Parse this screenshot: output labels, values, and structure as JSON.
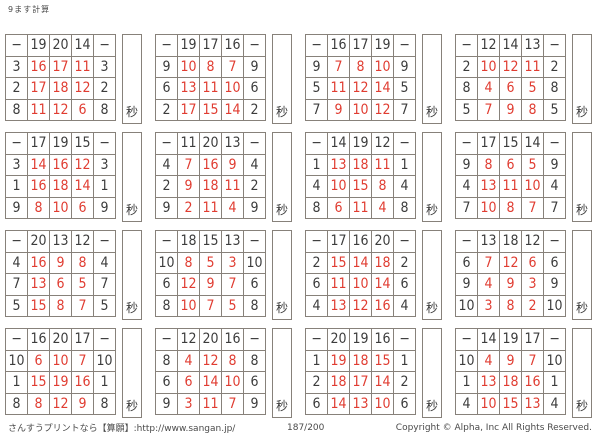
{
  "page": {
    "title": "9ます計算",
    "minus_sign": "−",
    "seconds_label": "秒",
    "footer": {
      "left": "さんすうプリントなら【算願】:http://www.sangan.jp/",
      "page_number": "187/200",
      "copyright": "Copyright © Alpha, Inc All Rights Reserved."
    }
  },
  "grids": [
    {
      "top": [
        "19",
        "20",
        "14"
      ],
      "rows": [
        {
          "left": "3",
          "answers": [
            "16",
            "17",
            "11"
          ]
        },
        {
          "left": "2",
          "answers": [
            "17",
            "18",
            "12"
          ]
        },
        {
          "left": "8",
          "answers": [
            "11",
            "12",
            "6"
          ]
        }
      ]
    },
    {
      "top": [
        "19",
        "17",
        "16"
      ],
      "rows": [
        {
          "left": "9",
          "answers": [
            "10",
            "8",
            "7"
          ]
        },
        {
          "left": "6",
          "answers": [
            "13",
            "11",
            "10"
          ]
        },
        {
          "left": "2",
          "answers": [
            "17",
            "15",
            "14"
          ]
        }
      ]
    },
    {
      "top": [
        "16",
        "17",
        "19"
      ],
      "rows": [
        {
          "left": "9",
          "answers": [
            "7",
            "8",
            "10"
          ]
        },
        {
          "left": "5",
          "answers": [
            "11",
            "12",
            "14"
          ]
        },
        {
          "left": "7",
          "answers": [
            "9",
            "10",
            "12"
          ]
        }
      ]
    },
    {
      "top": [
        "12",
        "14",
        "13"
      ],
      "rows": [
        {
          "left": "2",
          "answers": [
            "10",
            "12",
            "11"
          ]
        },
        {
          "left": "8",
          "answers": [
            "4",
            "6",
            "5"
          ]
        },
        {
          "left": "5",
          "answers": [
            "7",
            "9",
            "8"
          ]
        }
      ]
    },
    {
      "top": [
        "17",
        "19",
        "15"
      ],
      "rows": [
        {
          "left": "3",
          "answers": [
            "14",
            "16",
            "12"
          ]
        },
        {
          "left": "1",
          "answers": [
            "16",
            "18",
            "14"
          ]
        },
        {
          "left": "9",
          "answers": [
            "8",
            "10",
            "6"
          ]
        }
      ]
    },
    {
      "top": [
        "11",
        "20",
        "13"
      ],
      "rows": [
        {
          "left": "4",
          "answers": [
            "7",
            "16",
            "9"
          ]
        },
        {
          "left": "2",
          "answers": [
            "9",
            "18",
            "11"
          ]
        },
        {
          "left": "9",
          "answers": [
            "2",
            "11",
            "4"
          ]
        }
      ]
    },
    {
      "top": [
        "14",
        "19",
        "12"
      ],
      "rows": [
        {
          "left": "1",
          "answers": [
            "13",
            "18",
            "11"
          ]
        },
        {
          "left": "4",
          "answers": [
            "10",
            "15",
            "8"
          ]
        },
        {
          "left": "8",
          "answers": [
            "6",
            "11",
            "4"
          ]
        }
      ]
    },
    {
      "top": [
        "17",
        "15",
        "14"
      ],
      "rows": [
        {
          "left": "9",
          "answers": [
            "8",
            "6",
            "5"
          ]
        },
        {
          "left": "4",
          "answers": [
            "13",
            "11",
            "10"
          ]
        },
        {
          "left": "7",
          "answers": [
            "10",
            "8",
            "7"
          ]
        }
      ]
    },
    {
      "top": [
        "20",
        "13",
        "12"
      ],
      "rows": [
        {
          "left": "4",
          "answers": [
            "16",
            "9",
            "8"
          ]
        },
        {
          "left": "7",
          "answers": [
            "13",
            "6",
            "5"
          ]
        },
        {
          "left": "5",
          "answers": [
            "15",
            "8",
            "7"
          ]
        }
      ]
    },
    {
      "top": [
        "18",
        "15",
        "13"
      ],
      "rows": [
        {
          "left": "10",
          "answers": [
            "8",
            "5",
            "3"
          ]
        },
        {
          "left": "6",
          "answers": [
            "12",
            "9",
            "7"
          ]
        },
        {
          "left": "8",
          "answers": [
            "10",
            "7",
            "5"
          ]
        }
      ]
    },
    {
      "top": [
        "17",
        "16",
        "20"
      ],
      "rows": [
        {
          "left": "2",
          "answers": [
            "15",
            "14",
            "18"
          ]
        },
        {
          "left": "6",
          "answers": [
            "11",
            "10",
            "14"
          ]
        },
        {
          "left": "4",
          "answers": [
            "13",
            "12",
            "16"
          ]
        }
      ]
    },
    {
      "top": [
        "13",
        "18",
        "12"
      ],
      "rows": [
        {
          "left": "6",
          "answers": [
            "7",
            "12",
            "6"
          ]
        },
        {
          "left": "9",
          "answers": [
            "4",
            "9",
            "3"
          ]
        },
        {
          "left": "10",
          "answers": [
            "3",
            "8",
            "2"
          ]
        }
      ]
    },
    {
      "top": [
        "16",
        "20",
        "17"
      ],
      "rows": [
        {
          "left": "10",
          "answers": [
            "6",
            "10",
            "7"
          ]
        },
        {
          "left": "1",
          "answers": [
            "15",
            "19",
            "16"
          ]
        },
        {
          "left": "8",
          "answers": [
            "8",
            "12",
            "9"
          ]
        }
      ]
    },
    {
      "top": [
        "12",
        "20",
        "16"
      ],
      "rows": [
        {
          "left": "8",
          "answers": [
            "4",
            "12",
            "8"
          ]
        },
        {
          "left": "6",
          "answers": [
            "6",
            "14",
            "10"
          ]
        },
        {
          "left": "9",
          "answers": [
            "3",
            "11",
            "7"
          ]
        }
      ]
    },
    {
      "top": [
        "20",
        "19",
        "16"
      ],
      "rows": [
        {
          "left": "1",
          "answers": [
            "19",
            "18",
            "15"
          ]
        },
        {
          "left": "2",
          "answers": [
            "18",
            "17",
            "14"
          ]
        },
        {
          "left": "6",
          "answers": [
            "14",
            "13",
            "10"
          ]
        }
      ]
    },
    {
      "top": [
        "14",
        "19",
        "17"
      ],
      "rows": [
        {
          "left": "10",
          "answers": [
            "4",
            "9",
            "7"
          ]
        },
        {
          "left": "1",
          "answers": [
            "13",
            "18",
            "16"
          ]
        },
        {
          "left": "4",
          "answers": [
            "10",
            "15",
            "13"
          ]
        }
      ]
    }
  ]
}
